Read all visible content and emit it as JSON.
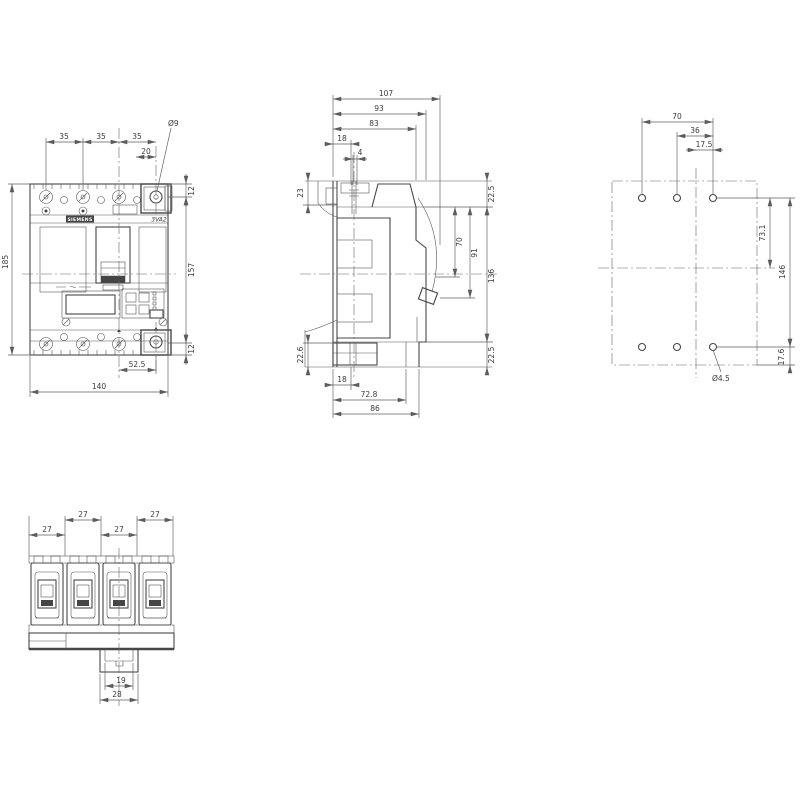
{
  "drawing": {
    "brand_label": "SIEMENS",
    "model_label": "3VA2",
    "views": {
      "front": {
        "pitch1": "35",
        "pitch2": "35",
        "pitch3": "35",
        "clamp_offset": "20",
        "terminal_hole": "Ø9",
        "margin_top": "12",
        "height_mid": "157",
        "margin_bottom": "12",
        "height_overall": "185",
        "center_to_clamp": "52.5",
        "width_overall": "140"
      },
      "side": {
        "depth_overall": "107",
        "depth_93": "93",
        "depth_83": "83",
        "top_18": "18",
        "top_4": "4",
        "left_23": "23",
        "right_top_225": "22.5",
        "right_70": "70",
        "right_91": "91",
        "right_136": "136",
        "right_bottom_225": "22.5",
        "left_226": "22.6",
        "bottom_18": "18",
        "bottom_728": "72.8",
        "bottom_86": "86"
      },
      "drill": {
        "span_70": "70",
        "span_36": "36",
        "span_175": "17.5",
        "v_731": "73.1",
        "v_146": "146",
        "v_176": "17.6",
        "hole_dia": "Ø4.5"
      },
      "bottom": {
        "pitch1": "27",
        "pitch2": "27",
        "pitch3": "27",
        "pitch4": "27",
        "notch_19": "19",
        "tab_28": "28"
      }
    }
  }
}
